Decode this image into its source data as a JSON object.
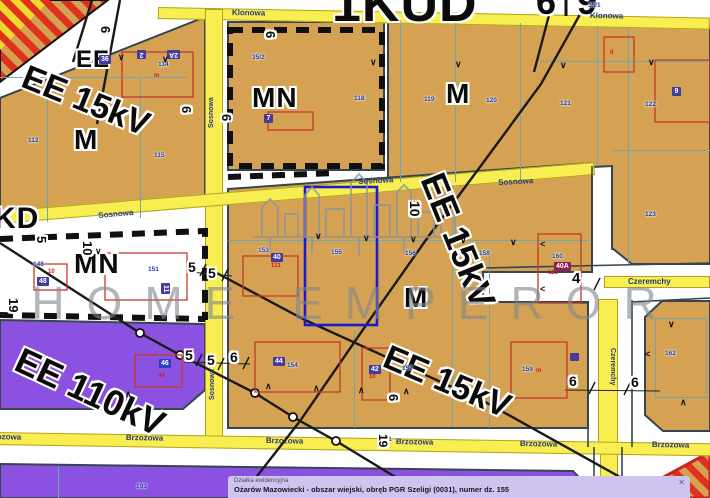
{
  "map": {
    "watermark": "HOME EMPEROR",
    "selected_parcel": "155",
    "colors": {
      "tan": "#d5a253",
      "purple": "#8b51e0",
      "roadYellow": "#f8ee52",
      "roadEdge": "#b3a31c",
      "border": "#36454f",
      "teal": "#6fa7b0",
      "red": "#c3392b",
      "hatchRed": "#e0301e",
      "hatchYellow": "#f0d92e",
      "badgeIndigo": "#453a9e",
      "badgeBlue": "#2b3ec8",
      "badgeMaroon": "#8c2050",
      "navy": "#1d3fa0",
      "selBlue": "#1a1ad0",
      "watermarkGray": "#7f868d",
      "panelBg": "#cfc4f1"
    },
    "layers": {
      "zone_labels": [
        [
          "1KUD",
          332,
          -22,
          52
        ],
        [
          "6",
          536,
          -16,
          36
        ],
        [
          "9",
          577,
          -16,
          36
        ],
        [
          "EE",
          76,
          48,
          24
        ],
        [
          "M",
          74,
          126,
          28
        ],
        [
          "MN",
          252,
          84,
          28
        ],
        [
          "M",
          446,
          80,
          28
        ],
        [
          "KD",
          -6,
          204,
          30
        ],
        [
          "MN",
          74,
          250,
          28
        ],
        [
          "M",
          404,
          284,
          28
        ]
      ],
      "power_labels": [
        [
          "EE 15kV",
          30,
          60,
          34,
          22
        ],
        [
          "EE 15kV",
          448,
          168,
          36,
          68
        ],
        [
          "EE 110kV",
          25,
          342,
          36,
          25
        ],
        [
          "EE 15kV",
          392,
          340,
          34,
          23
        ]
      ],
      "street_labels": [
        [
          "Klonowa",
          232,
          9,
          8,
          1
        ],
        [
          "Klonowa",
          590,
          12,
          8,
          1
        ],
        [
          "Sosnowa",
          98,
          212,
          8,
          -5
        ],
        [
          "Sosnowa",
          358,
          178,
          8,
          -3
        ],
        [
          "Sosnowa",
          498,
          179,
          8,
          -3
        ],
        [
          "Sosnowa",
          208,
          128,
          7,
          -90
        ],
        [
          "Sosnowa",
          209,
          400,
          7,
          -90
        ],
        [
          "Brzozowa",
          -16,
          433,
          8,
          1
        ],
        [
          "Brzozowa",
          126,
          434,
          8,
          1
        ],
        [
          "Brzozowa",
          266,
          437,
          8,
          1
        ],
        [
          "Brzozowa",
          396,
          438,
          8,
          1
        ],
        [
          "Brzozowa",
          520,
          440,
          8,
          1
        ],
        [
          "Brzozowa",
          652,
          441,
          8,
          1
        ],
        [
          "Czeremchy",
          628,
          278,
          8,
          0
        ],
        [
          "Czeremchy",
          616,
          348,
          7,
          90
        ]
      ],
      "parcel_numbers": [
        [
          "35/1",
          588,
          3
        ],
        [
          "35/2",
          252,
          55
        ],
        [
          "112",
          28,
          138
        ],
        [
          "114",
          158,
          62
        ],
        [
          "115",
          154,
          153
        ],
        [
          "118",
          354,
          96
        ],
        [
          "119",
          424,
          97
        ],
        [
          "120",
          486,
          98
        ],
        [
          "121",
          560,
          101
        ],
        [
          "122",
          645,
          102
        ],
        [
          "123",
          645,
          212
        ],
        [
          "148",
          33,
          262
        ],
        [
          "151",
          148,
          267
        ],
        [
          "153",
          258,
          248
        ],
        [
          "155",
          331,
          250
        ],
        [
          "156",
          405,
          251
        ],
        [
          "158",
          479,
          251
        ],
        [
          "160",
          552,
          254
        ],
        [
          "154",
          287,
          363
        ],
        [
          "157",
          402,
          366
        ],
        [
          "159",
          522,
          367
        ],
        [
          "162",
          665,
          351
        ],
        [
          "181",
          381,
          437
        ],
        [
          "193",
          136,
          484
        ],
        [
          "191",
          489,
          488
        ],
        [
          "196",
          603,
          486
        ]
      ],
      "badges": [
        [
          "2",
          146,
          59,
          "i",
          180
        ],
        [
          "2A",
          180,
          59,
          "i",
          180
        ],
        [
          "9",
          672,
          87,
          "i",
          0
        ],
        [
          "36",
          99,
          55,
          "i",
          0
        ],
        [
          "40",
          271,
          253,
          "i",
          0
        ],
        [
          "40A",
          554,
          262,
          "m",
          0
        ],
        [
          "48",
          37,
          277,
          "i",
          0
        ],
        [
          "11",
          170,
          283,
          "i",
          90
        ],
        [
          "44",
          273,
          357,
          "i",
          0
        ],
        [
          "42",
          369,
          365,
          "i",
          0
        ],
        [
          "46",
          159,
          359,
          "b",
          0
        ],
        [
          "7",
          264,
          114,
          "i",
          0
        ],
        [
          "",
          570,
          353,
          "i",
          0
        ]
      ],
      "red_marks": [
        [
          "m",
          154,
          73
        ],
        [
          "m",
          536,
          368
        ],
        [
          "121",
          271,
          263
        ],
        [
          "121",
          548,
          270
        ],
        [
          "10",
          48,
          269
        ],
        [
          "10",
          369,
          374
        ],
        [
          "44",
          158,
          373
        ],
        [
          "II",
          610,
          50
        ]
      ],
      "dim_marks": [
        [
          "6",
          112,
          26,
          13,
          90
        ],
        [
          "6",
          277,
          31,
          13,
          90
        ],
        [
          "6",
          193,
          106,
          13,
          90
        ],
        [
          "6",
          233,
          114,
          13,
          90
        ],
        [
          "5",
          48,
          236,
          13,
          90
        ],
        [
          "10",
          94,
          241,
          13,
          90
        ],
        [
          "10",
          422,
          201,
          14,
          90
        ],
        [
          "5",
          188,
          260,
          14,
          0
        ],
        [
          "5",
          208,
          266,
          14,
          0
        ],
        [
          "5",
          185,
          348,
          14,
          0
        ],
        [
          "5",
          207,
          353,
          14,
          0
        ],
        [
          "19",
          20,
          298,
          13,
          90
        ],
        [
          "4",
          572,
          271,
          15,
          0
        ],
        [
          "6",
          230,
          350,
          14,
          0
        ],
        [
          "6",
          569,
          374,
          14,
          0
        ],
        [
          "6",
          631,
          375,
          14,
          0
        ],
        [
          "6",
          400,
          394,
          13,
          90
        ],
        [
          "19",
          389,
          434,
          12,
          90
        ]
      ],
      "ticks": [
        [
          "∨",
          118,
          53
        ],
        [
          "∨",
          162,
          55
        ],
        [
          "∨",
          370,
          58
        ],
        [
          "∨",
          455,
          60
        ],
        [
          "∨",
          560,
          61
        ],
        [
          "∨",
          648,
          58
        ],
        [
          "∨",
          315,
          232
        ],
        [
          "∨",
          363,
          234
        ],
        [
          "∨",
          410,
          235
        ],
        [
          "∨",
          460,
          236
        ],
        [
          "∨",
          510,
          238
        ],
        [
          "∧",
          265,
          382
        ],
        [
          "∧",
          313,
          384
        ],
        [
          "∧",
          358,
          386
        ],
        [
          "∧",
          403,
          387
        ],
        [
          "<",
          540,
          240
        ],
        [
          "<",
          540,
          285
        ],
        [
          "∧",
          125,
          390
        ],
        [
          "∨",
          668,
          320
        ],
        [
          "∧",
          680,
          398
        ],
        [
          "<",
          645,
          350
        ],
        [
          "∨",
          95,
          247
        ]
      ]
    }
  },
  "info_panel": {
    "title": "Działka ewidencyjna",
    "description": "Ożarów Mazowiecki - obszar wiejski, obręb PGR Szeligi (0031), numer dz. 155",
    "close": "✕"
  }
}
